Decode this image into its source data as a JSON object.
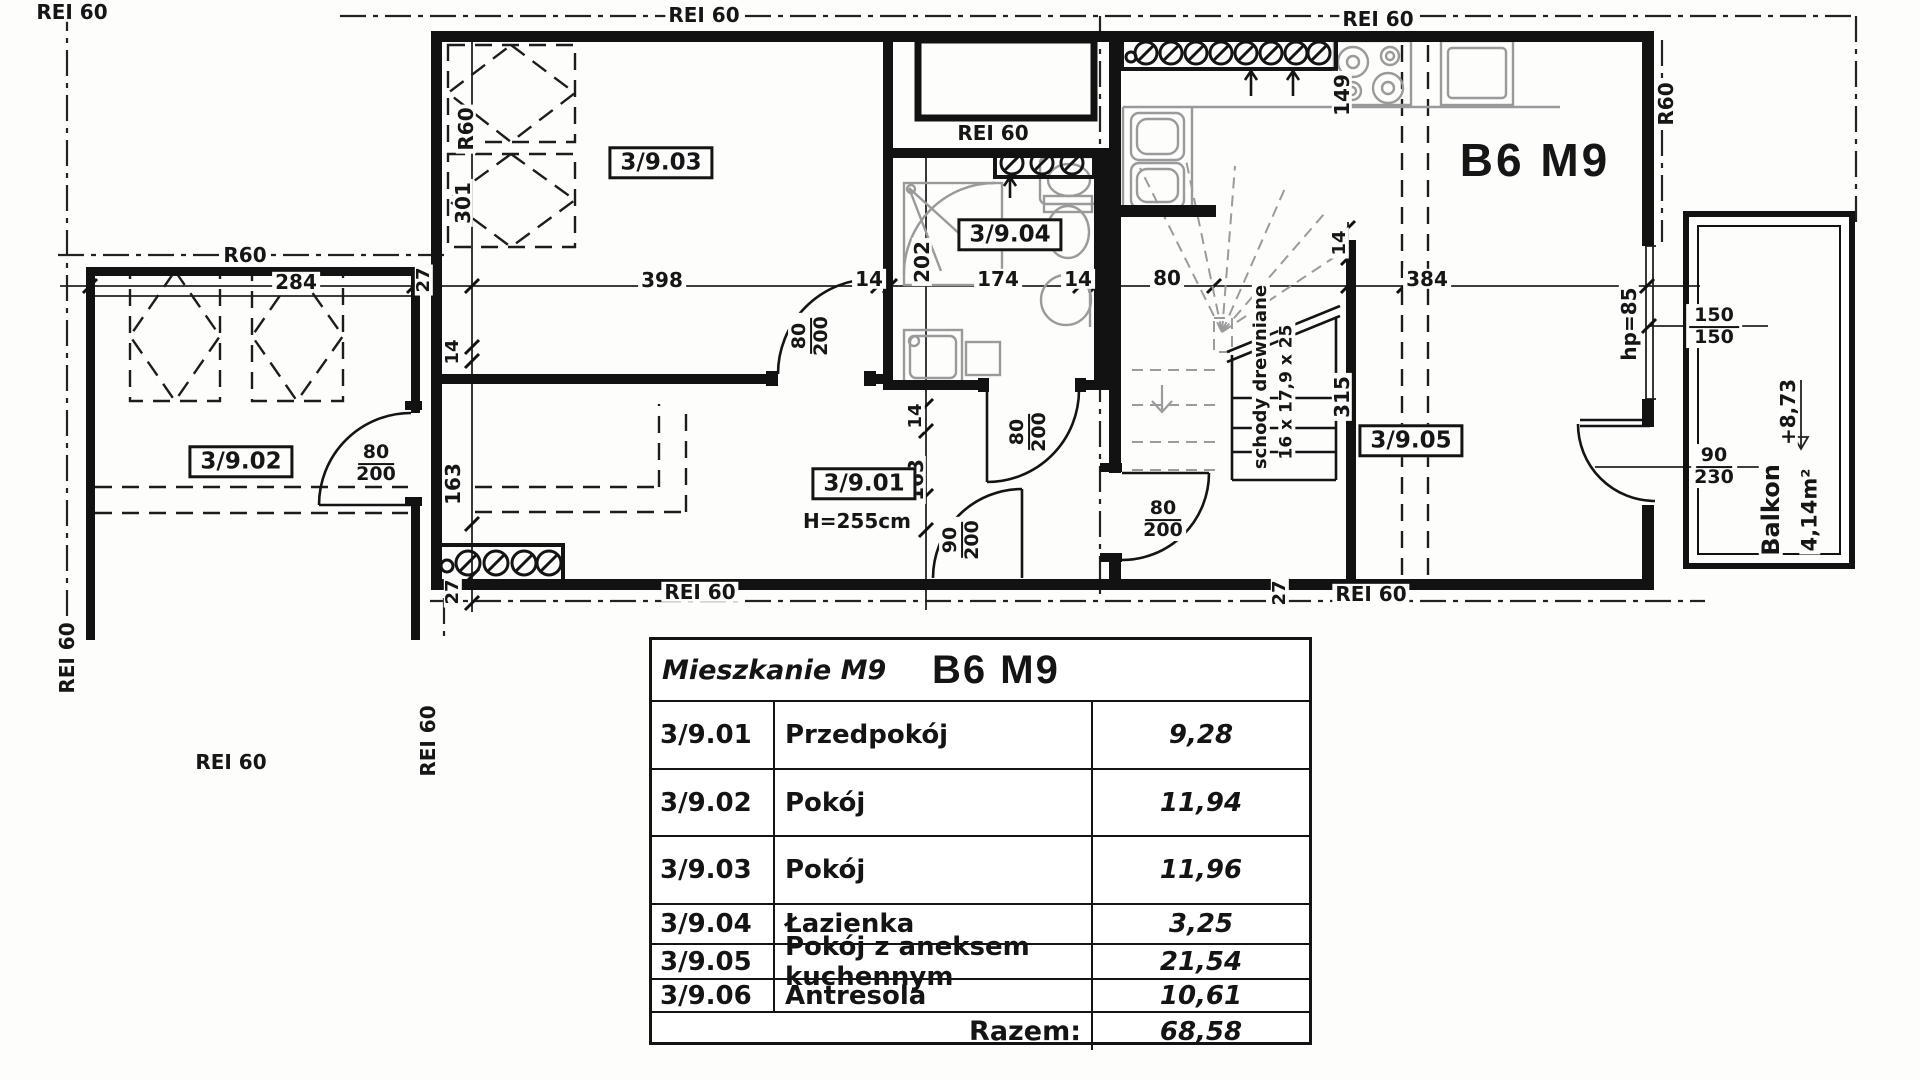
{
  "title": "B6 M9",
  "plan": {
    "fire": {
      "rei60": "REI 60",
      "r60": "R60"
    },
    "rooms": {
      "r301": "3/9.01",
      "r301_height": "H=255cm",
      "r302": "3/9.02",
      "r303": "3/9.03",
      "r304": "3/9.04",
      "r305": "3/9.05"
    },
    "dims": {
      "d284": "284",
      "d27": "27",
      "d398": "398",
      "d14": "14",
      "d174": "174",
      "d80": "80",
      "d384": "384",
      "d301": "301",
      "d163": "163",
      "d202": "202",
      "d315": "315",
      "d149": "149"
    },
    "doors": {
      "d80_200": {
        "w": "80",
        "h": "200"
      },
      "d90_200": {
        "w": "90",
        "h": "200"
      },
      "d90_230": {
        "w": "90",
        "h": "230"
      }
    },
    "window": {
      "w": "150",
      "h": "150"
    },
    "balcony": {
      "name": "Balkon",
      "area": "4,14m²",
      "level": "+8,73",
      "sill_height": "hp=85"
    },
    "stairs": {
      "material": "schody drewniane",
      "dimensions": "16 x 17,9 x 25"
    }
  },
  "table": {
    "header_left": "Mieszkanie M9",
    "header_right": "B6 M9",
    "rows": [
      {
        "no": "3/9.01",
        "name": "Przedpokój",
        "area": "9,28"
      },
      {
        "no": "3/9.02",
        "name": "Pokój",
        "area": "11,94"
      },
      {
        "no": "3/9.03",
        "name": "Pokój",
        "area": "11,96"
      },
      {
        "no": "3/9.04",
        "name": "Łazienka",
        "area": "3,25"
      },
      {
        "no": "3/9.05",
        "name": "Pokój z aneksem kuchennym",
        "area": "21,54"
      },
      {
        "no": "3/9.06",
        "name": "Antresola",
        "area": "10,61"
      }
    ],
    "total_label": "Razem:",
    "total_value": "68,58"
  }
}
